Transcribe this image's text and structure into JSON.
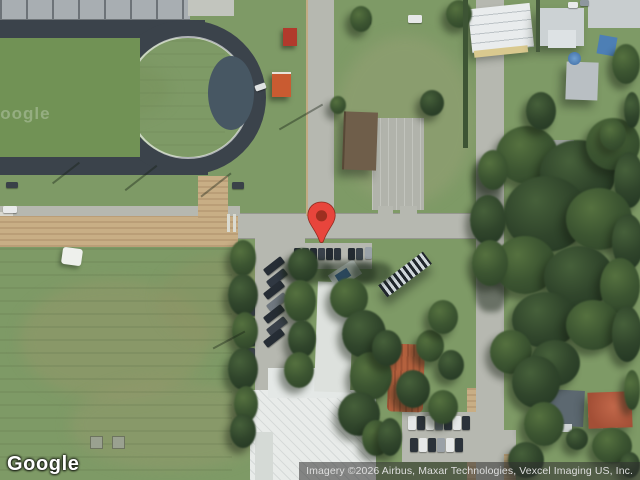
{
  "map": {
    "type": "satellite-imagery",
    "watermark_logo": "Google",
    "watermark_tile": "Google",
    "attribution_text": "Imagery ©2026 Airbus, Maxar Technologies, Vexcel Imaging US, Inc.",
    "marker": {
      "name": "location-pin",
      "fill": "#E8453C",
      "core": "#9E2F20",
      "outline": "#8F2A1E"
    },
    "colors": {
      "grass": "#7E9A66",
      "road": "#B6B8B0",
      "dirt_path": "#C8AE85",
      "running_track": "#3B434B",
      "tree_canopy": "#3A5233",
      "white_roof": "#E8EBE9",
      "attribution_bg": "#303030",
      "attribution_text": "#DEDEDE"
    }
  }
}
